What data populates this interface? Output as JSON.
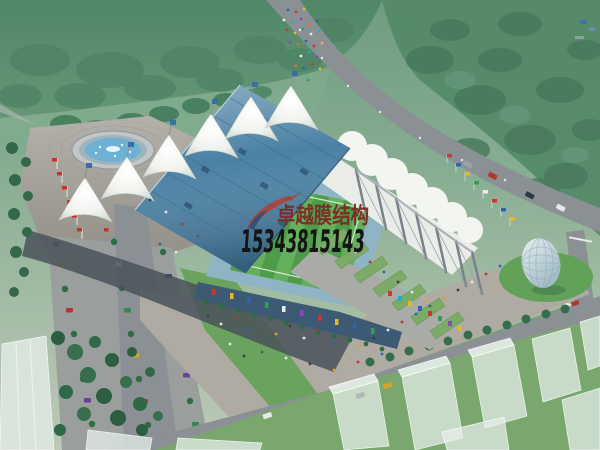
{
  "image": {
    "kind": "aerial architectural rendering",
    "subject": "tensile membrane stadium sports complex"
  },
  "watermark": {
    "logo_icon": "red-swoosh-logo",
    "brand_text": "卓越膜结构",
    "phone_number": "15343815143",
    "brand_color": "#7c2a24",
    "phone_color": "#141414"
  },
  "palette": {
    "canvas_top_green": "#6f9c80",
    "canvas_bottom_green": "#bcc9b8",
    "forest_green": "#4e8667",
    "lawn_green": "#6aa35e",
    "pitch_green": "#4e9b4a",
    "pitch_stripe_green": "#68b35f",
    "road_gray": "#8b9094",
    "plaza_gray": "#b0aba2",
    "shadow_gray": "#4a525a",
    "roof_blue": "#4b81a4",
    "seating_blue": "#8fb4c6",
    "membrane_white": "#f3f5f1",
    "facade_blue": "#3c5a74",
    "water_blue": "#6fb1d4",
    "dome_glass": "#c9dbe2",
    "flag_red": "#c3352b"
  },
  "scene_labels": {
    "stadium": "membrane-roof stadium",
    "pitch": "striped football pitch",
    "fountain": "circular fountain plaza",
    "glass_dome": "egg-shaped glass pavilion",
    "crowd": "pedestrians on road",
    "parking": "tree-lined parking avenue"
  }
}
